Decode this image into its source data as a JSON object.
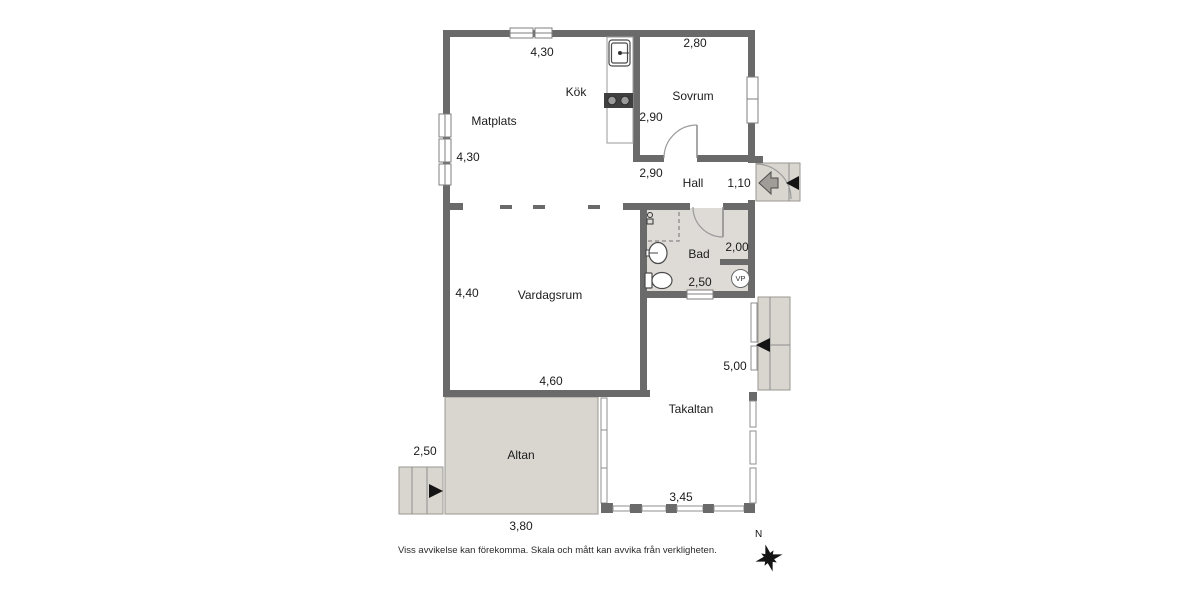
{
  "plan": {
    "rooms": {
      "kitchen": "Kök",
      "bedroom": "Sovrum",
      "dining": "Matplats",
      "hall": "Hall",
      "bath": "Bad",
      "living": "Vardagsrum",
      "roof_terrace": "Takaltan",
      "terrace": "Altan"
    },
    "measurements": {
      "kitchen_top": "4,30",
      "bedroom_top": "2,80",
      "kitchen_wall": "2,90",
      "dining_left": "4,30",
      "hall_top": "2,90",
      "entry_width": "1,10",
      "bath_right": "2,00",
      "bath_bottom": "2,50",
      "living_left": "4,40",
      "living_bottom": "4,60",
      "roof_terrace_right": "5,00",
      "roof_terrace_bottom": "3,45",
      "terrace_steps": "2,50",
      "terrace_bottom": "3,80"
    },
    "badges": {
      "heat_pump": "VP"
    },
    "compass": {
      "north": "N"
    },
    "disclaimer": "Viss avvikelse kan förekomma. Skala och mått kan avvika från verkligheten.",
    "colors": {
      "wall": "#6a6a6a",
      "outdoor_fill": "#d9d6d0",
      "bath_fill": "#dedbd6",
      "stove": "#3f3f3f",
      "text": "#1c1c1c"
    },
    "icons": [
      "sink-icon",
      "stove-icon",
      "washbasin-icon",
      "toilet-icon",
      "floor-drain-icon",
      "shower-area",
      "heat-pump-badge",
      "compass-rose-icon",
      "entry-arrow-icon",
      "stair-direction-arrow-icon",
      "window",
      "door-arc"
    ]
  }
}
